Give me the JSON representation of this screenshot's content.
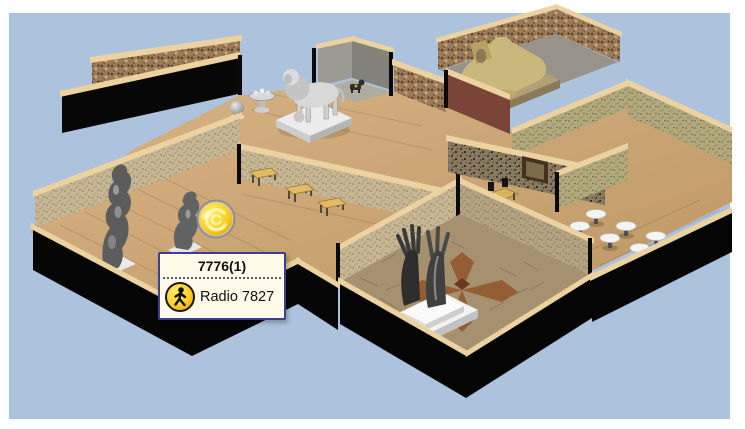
{
  "canvas": {
    "background_color": "#adc2dd",
    "frame_color": "#ffffff"
  },
  "tooltip": {
    "title": "7776(1)",
    "agent_label": "Radio 7827",
    "icon": "pedestrian-icon",
    "background_color": "#fffbe8",
    "border_color": "#3f3f8f"
  },
  "marker": {
    "icon": "agent-coin-icon",
    "color": "#f5b800"
  },
  "scene": {
    "objects": [
      "lion-statue",
      "sphinx-statue",
      "hand-sculpture",
      "standing-figure-statue",
      "small-figure-statue",
      "fountain-exhibit",
      "sphere-exhibit",
      "dog-statue",
      "wall-painting",
      "bench",
      "stool"
    ]
  }
}
